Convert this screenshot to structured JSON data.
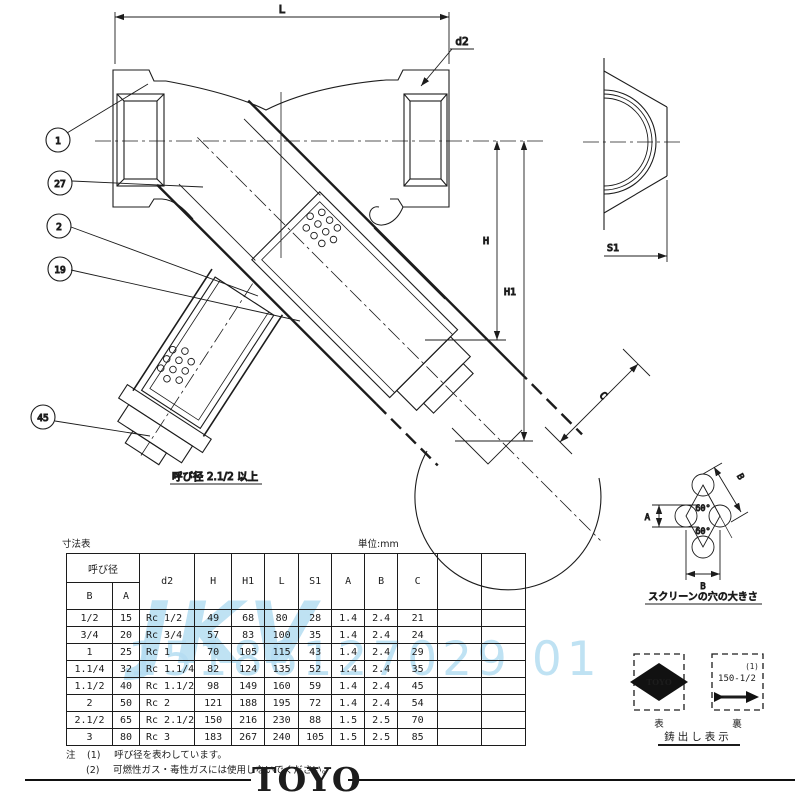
{
  "title_block": {
    "table_title": "寸法表",
    "unit_label": "単位:mm"
  },
  "drawing": {
    "dims": {
      "L": "L",
      "d2": "d2",
      "H": "H",
      "H1": "H1",
      "S1": "S1",
      "C": "C"
    },
    "balloons": {
      "b1": "1",
      "b27": "27",
      "b2": "2",
      "b19": "19",
      "b45": "45"
    },
    "detail_caption": "呼び径 2.1/2 以上",
    "screen_hole": {
      "caption": "スクリーンの穴の大きさ",
      "angle_top": "60°",
      "angle_bottom": "60°",
      "dim_a": "A",
      "dim_b_bottom": "B",
      "dim_b_diagonal": "B"
    },
    "casting_marks": {
      "caption": "鋳出し表示",
      "front_label": "表",
      "back_label": "裏",
      "logo_text": "TOYO",
      "note_ref": "(1)",
      "size_text": "150-1/2"
    }
  },
  "table": {
    "nominal_header": "呼び径",
    "columns": [
      "B",
      "A",
      "d2",
      "H",
      "H1",
      "L",
      "S1",
      "A",
      "B",
      "C"
    ],
    "rows": [
      [
        "1/2",
        "15",
        "Rc 1/2",
        "49",
        "68",
        "80",
        "28",
        "1.4",
        "2.4",
        "21"
      ],
      [
        "3/4",
        "20",
        "Rc 3/4",
        "57",
        "83",
        "100",
        "35",
        "1.4",
        "2.4",
        "24"
      ],
      [
        "1",
        "25",
        "Rc 1",
        "70",
        "105",
        "115",
        "43",
        "1.4",
        "2.4",
        "29"
      ],
      [
        "1.1/4",
        "32",
        "Rc 1.1/4",
        "82",
        "124",
        "135",
        "52",
        "1.4",
        "2.4",
        "35"
      ],
      [
        "1.1/2",
        "40",
        "Rc 1.1/2",
        "98",
        "149",
        "160",
        "59",
        "1.4",
        "2.4",
        "45"
      ],
      [
        "2",
        "50",
        "Rc 2",
        "121",
        "188",
        "195",
        "72",
        "1.4",
        "2.4",
        "54"
      ],
      [
        "2.1/2",
        "65",
        "Rc 2.1/2",
        "150",
        "216",
        "230",
        "88",
        "1.5",
        "2.5",
        "70"
      ],
      [
        "3",
        "80",
        "Rc 3",
        "183",
        "267",
        "240",
        "105",
        "1.5",
        "2.5",
        "85"
      ]
    ]
  },
  "notes": {
    "prefix": "注",
    "note1_no": "(1)",
    "note1": "呼び径を表わしています。",
    "note2_no": "(2)",
    "note2": "可燃性ガス・毒性ガスには使用しないでください。"
  },
  "footer": {
    "brand": "TOYO"
  },
  "watermark": {
    "line1": "JKV",
    "line2": "15186127029 01"
  },
  "colors": {
    "line": "#1c1c1c",
    "watermark": "#b5ddf2",
    "paper": "#ffffff"
  }
}
